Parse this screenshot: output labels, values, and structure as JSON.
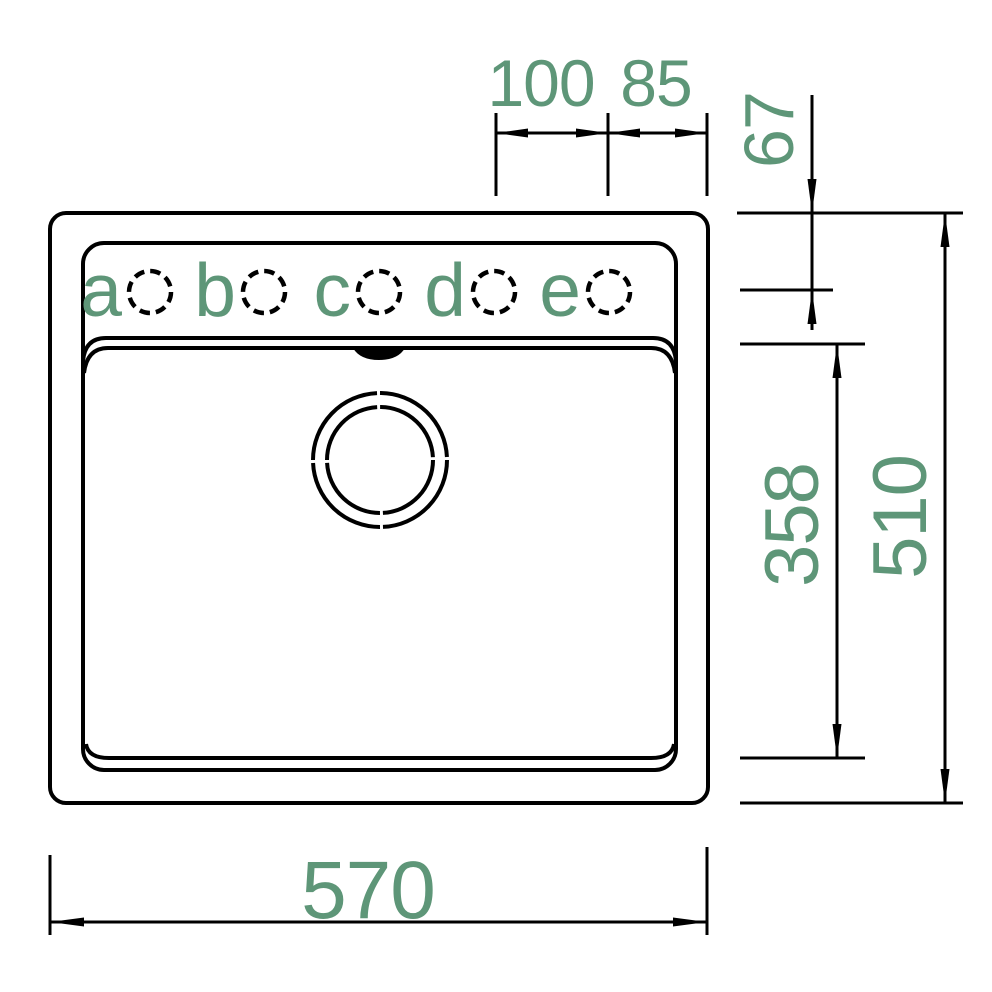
{
  "drawing": {
    "kind": "sink-installation-drawing",
    "view": "top-view"
  },
  "colors": {
    "dimension_text": "#5e9678",
    "line": "#000000",
    "background": "#ffffff"
  },
  "tap_holes": [
    {
      "label": "a"
    },
    {
      "label": "b"
    },
    {
      "label": "c"
    },
    {
      "label": "d"
    },
    {
      "label": "e"
    }
  ],
  "dimensions": {
    "hole_spacing": "100",
    "hole_to_edge": "85",
    "edge_to_hole_center": "67",
    "bowl_depth": "358",
    "overall_depth": "510",
    "overall_width": "570"
  }
}
